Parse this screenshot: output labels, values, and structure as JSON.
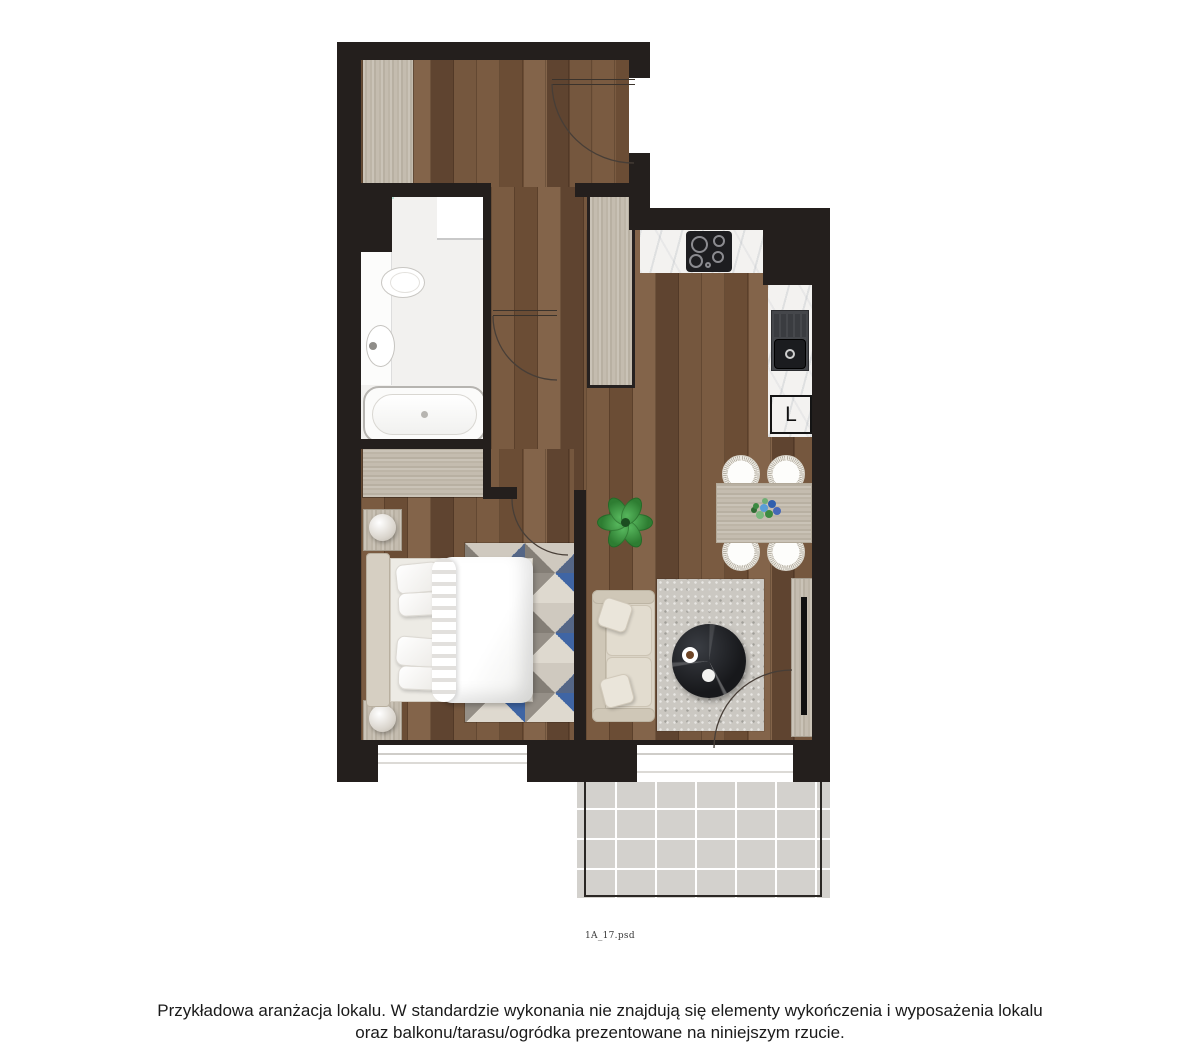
{
  "plan": {
    "filename_label": "1A_17.psd",
    "fridge_label": "L"
  },
  "footer": {
    "line1": "Przykładowa aranżacja lokalu. W standardzie wykonania nie znajdują się elementy wykończenia i wyposażenia lokalu",
    "line2": "oraz balkonu/tarasu/ogródka prezentowane na niniejszym rzucie."
  },
  "colors": {
    "wall": "#241f1d",
    "wood_floor": "#72553c",
    "light_wood": "#c3bbae",
    "marble": "#f3f2f0",
    "balcony_tile": "#d3d1cd",
    "rug_blue": "#3f65a4",
    "rug_gray": "#948e86",
    "rug_cream": "#ded9cf",
    "sofa_beige": "#dbd4c6",
    "plant_green": "#2e7d32",
    "tile_palette": [
      "#5b7fc4",
      "#3d5a9e",
      "#6fb39a",
      "#4a7f6d",
      "#86c3d8",
      "#37536b",
      "#7fb9ae",
      "#2e4a8f",
      "#9ccfc0",
      "#53678a",
      "#406b52",
      "#74a8c9",
      "#355e46",
      "#8bc0d0"
    ]
  }
}
